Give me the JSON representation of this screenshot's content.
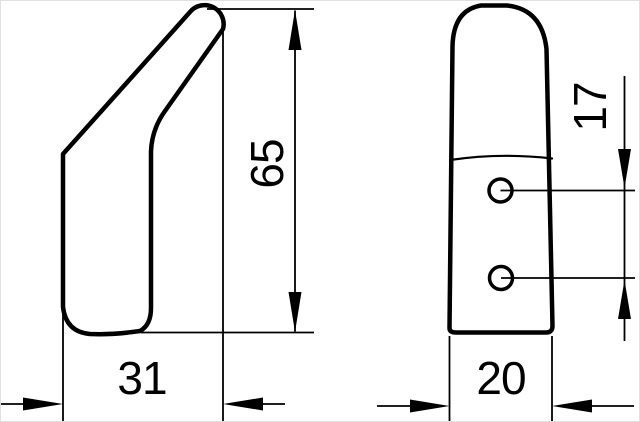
{
  "drawing": {
    "title": "Wall hook technical drawing, two orthographic views",
    "background_color": "#ffffff",
    "line_color": "#000000",
    "views": {
      "side_view": {
        "name": "side profile view of hook",
        "dimensions": {
          "height": "65",
          "depth": "31"
        }
      },
      "front_view": {
        "name": "front view of hook with mounting holes",
        "hole_count": 2,
        "dimensions": {
          "width": "20",
          "hole_spacing": "17"
        }
      }
    }
  }
}
